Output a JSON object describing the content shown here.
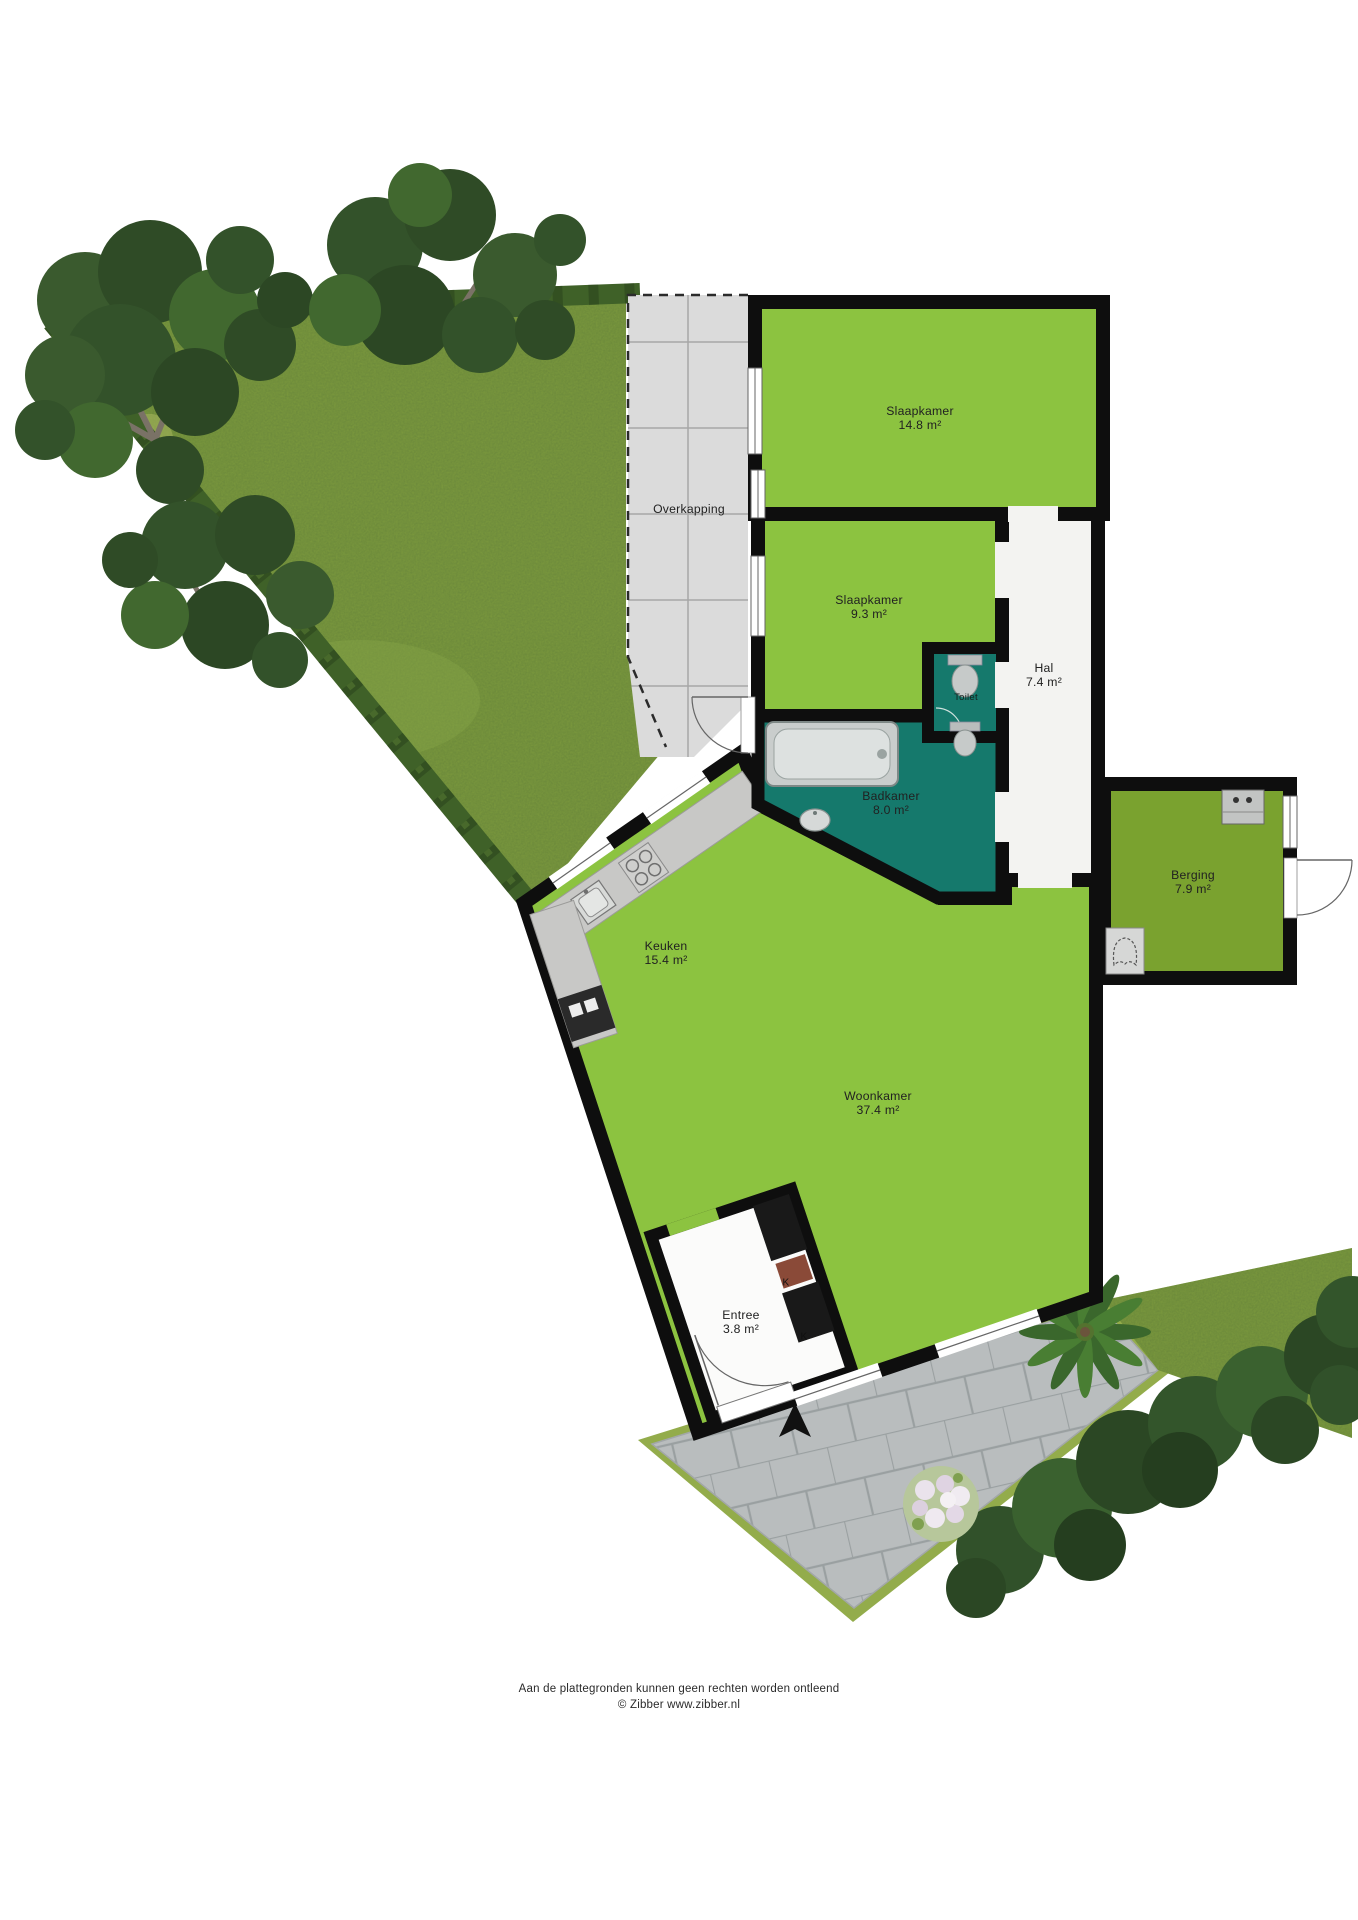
{
  "plan_title": "Plattegrond begane grond met tuin",
  "rooms": [
    {
      "name": "Overkapping",
      "area": ""
    },
    {
      "name": "Slaapkamer",
      "area": "14.8 m²"
    },
    {
      "name": "Slaapkamer",
      "area": "9.3 m²"
    },
    {
      "name": "Hal",
      "area": "7.4 m²"
    },
    {
      "name": "Toilet",
      "area": ""
    },
    {
      "name": "Badkamer",
      "area": "8.0 m²"
    },
    {
      "name": "Berging",
      "area": "7.9 m²"
    },
    {
      "name": "Keuken",
      "area": "15.4 m²"
    },
    {
      "name": "Woonkamer",
      "area": "37.4 m²"
    },
    {
      "name": "Entree",
      "area": "3.8 m²"
    }
  ],
  "annotations": {
    "closet1": "K",
    "closet2": "K"
  },
  "footer": {
    "line1": "Aan de plattegronden kunnen geen rechten worden ontleend",
    "line2": "© Zibber www.zibber.nl"
  },
  "colors": {
    "room_green": "#8cc340",
    "berging_green": "#7aa22f",
    "bathroom_teal": "#15796c",
    "wall_black": "#0e0e0e",
    "lawn_green": "#7f9d3e",
    "hedge_green": "#3f6128",
    "overkapping_gray": "#dbdbdb",
    "paver_gray": "#b9bdbe",
    "hall_floor": "#f3f3f1"
  }
}
